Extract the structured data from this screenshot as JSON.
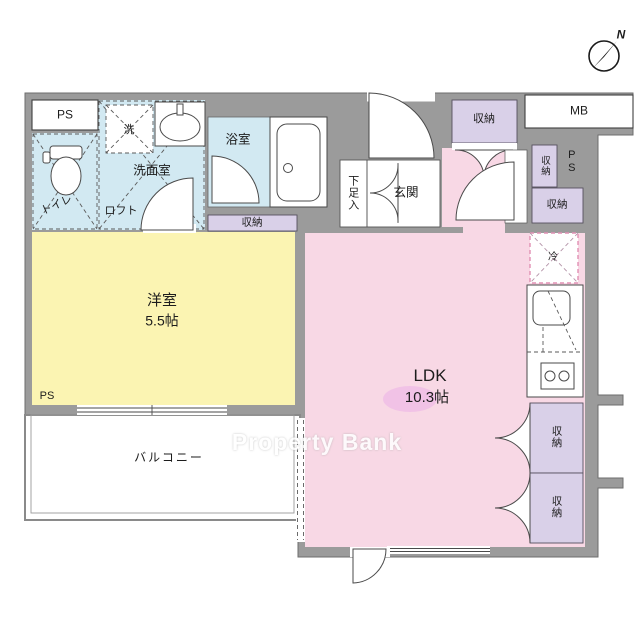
{
  "plan": {
    "rooms": {
      "western_room": {
        "name": "洋室",
        "size": "5.5帖"
      },
      "ldk": {
        "name": "LDK",
        "size": "10.3帖"
      },
      "balcony": {
        "name": "バルコニー"
      },
      "entrance": {
        "name": "玄関"
      },
      "shoe_cabinet": {
        "name": "下足入"
      },
      "bathroom": {
        "name": "浴室"
      },
      "washroom": {
        "name": "洗面室"
      },
      "toilet": {
        "name": "トイレ"
      },
      "loft": {
        "name": "ロフト"
      }
    },
    "fixtures": {
      "washer": "洗",
      "fridge": "冷",
      "storage": "収納",
      "pipe_space": "PS",
      "meter_box": "MB"
    },
    "compass": {
      "north": "N"
    },
    "watermark": "Property Bank"
  },
  "colors": {
    "wall": "#9b9b9b",
    "room_yellow": "#fbf4b2",
    "room_pink": "#f8d8e5",
    "room_blue": "#d2e9f2",
    "storage_purple": "#d9d0e8",
    "fridge_dash": "#e090b4",
    "highlight_blob": "#e9a9e6",
    "watermark_text": "#ffffff"
  }
}
